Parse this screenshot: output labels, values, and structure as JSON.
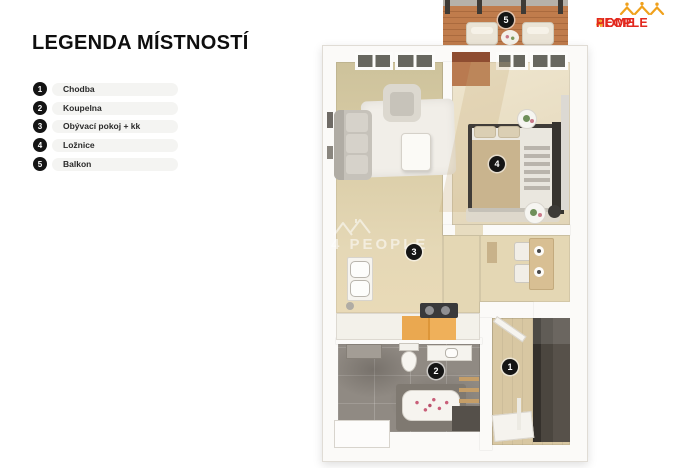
{
  "legend": {
    "title": "LEGENDA MÍSTNOSTÍ",
    "items": [
      {
        "number": "1",
        "label": "Chodba"
      },
      {
        "number": "2",
        "label": "Koupelna"
      },
      {
        "number": "3",
        "label": "Obývací pokoj + kk"
      },
      {
        "number": "4",
        "label": "Ložnice"
      },
      {
        "number": "5",
        "label": "Balkon"
      }
    ]
  },
  "logo": {
    "text_home": "HOME",
    "text_4": "4",
    "text_people": "PEOPLE",
    "color_red": "#e2281e",
    "color_orange": "#f0a11c",
    "icon": "crown-icon"
  },
  "watermark": {
    "text": "4 PEOPLE",
    "icon": "house-icon"
  },
  "floorplan": {
    "room_markers": [
      {
        "number": "1",
        "room": "Chodba"
      },
      {
        "number": "2",
        "room": "Koupelna"
      },
      {
        "number": "3",
        "room": "Obývací pokoj + kk"
      },
      {
        "number": "4",
        "room": "Ložnice"
      },
      {
        "number": "5",
        "room": "Balkon"
      }
    ],
    "colors": {
      "marker_bg": "#151515",
      "legend_pill_bg": "#f4f4f2",
      "living_floor": "#e0d3ae",
      "bedroom_floor": "#e9dfc6",
      "hall_floor": "#d8c7a2",
      "bath_tile": "#908a83",
      "balcony_wood": "#c07c4c",
      "counter_wood": "#eaa850",
      "wall": "#fbfaf8"
    }
  }
}
